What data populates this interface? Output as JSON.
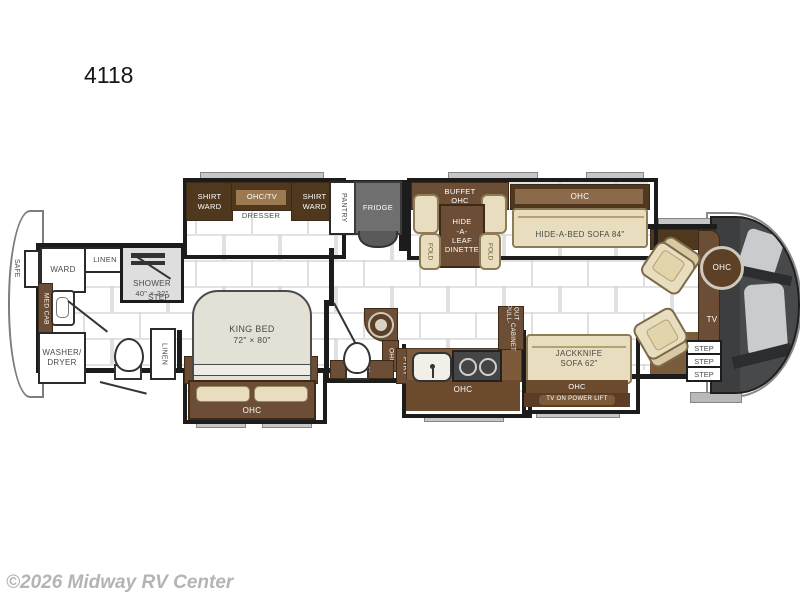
{
  "title": "4118",
  "watermark": "©2026 Midway RV Center",
  "colors": {
    "wall": "#1c1c1c",
    "cabinet": "#6b4e35",
    "cabinet_dark": "#50381f",
    "slide_floor": "#6b4a2e",
    "tan": "#e9ddbf",
    "fridge": "#6f6f6f",
    "front_cap": "#47494b"
  },
  "labels": {
    "safe": "SAFE",
    "ward": "WARD",
    "linen": "LINEN",
    "shower": "SHOWER",
    "shower_size": "40\" × 32\"",
    "med_cab": "MED CAB",
    "step": "STEP",
    "washer_line1": "WASHER/",
    "washer_line2": "DRYER",
    "king_bed": "KING BED",
    "king_size": "72\" × 80\"",
    "ohc": "OHC",
    "shirt": "SHIRT",
    "ohc_tv": "OHC/TV",
    "dresser": "DRESSER",
    "pantry": "PANTRY",
    "fridge": "FRIDGE",
    "buffet_line1": "BUFFET",
    "dinette": [
      "HIDE",
      "-A-",
      "LEAF",
      "DINETTE"
    ],
    "fold": "FOLD",
    "hide_a_bed": "HIDE-A-BED SOFA 84\"",
    "pull_out_line1": "PULL-OUT",
    "pull_out_line2": "CABINET",
    "ptry": "PTRY",
    "jackknife_line1": "JACKKNIFE",
    "jackknife_line2": "SOFA 62\"",
    "tv_lift": "TV ON POWER LIFT",
    "tv": "TV"
  }
}
